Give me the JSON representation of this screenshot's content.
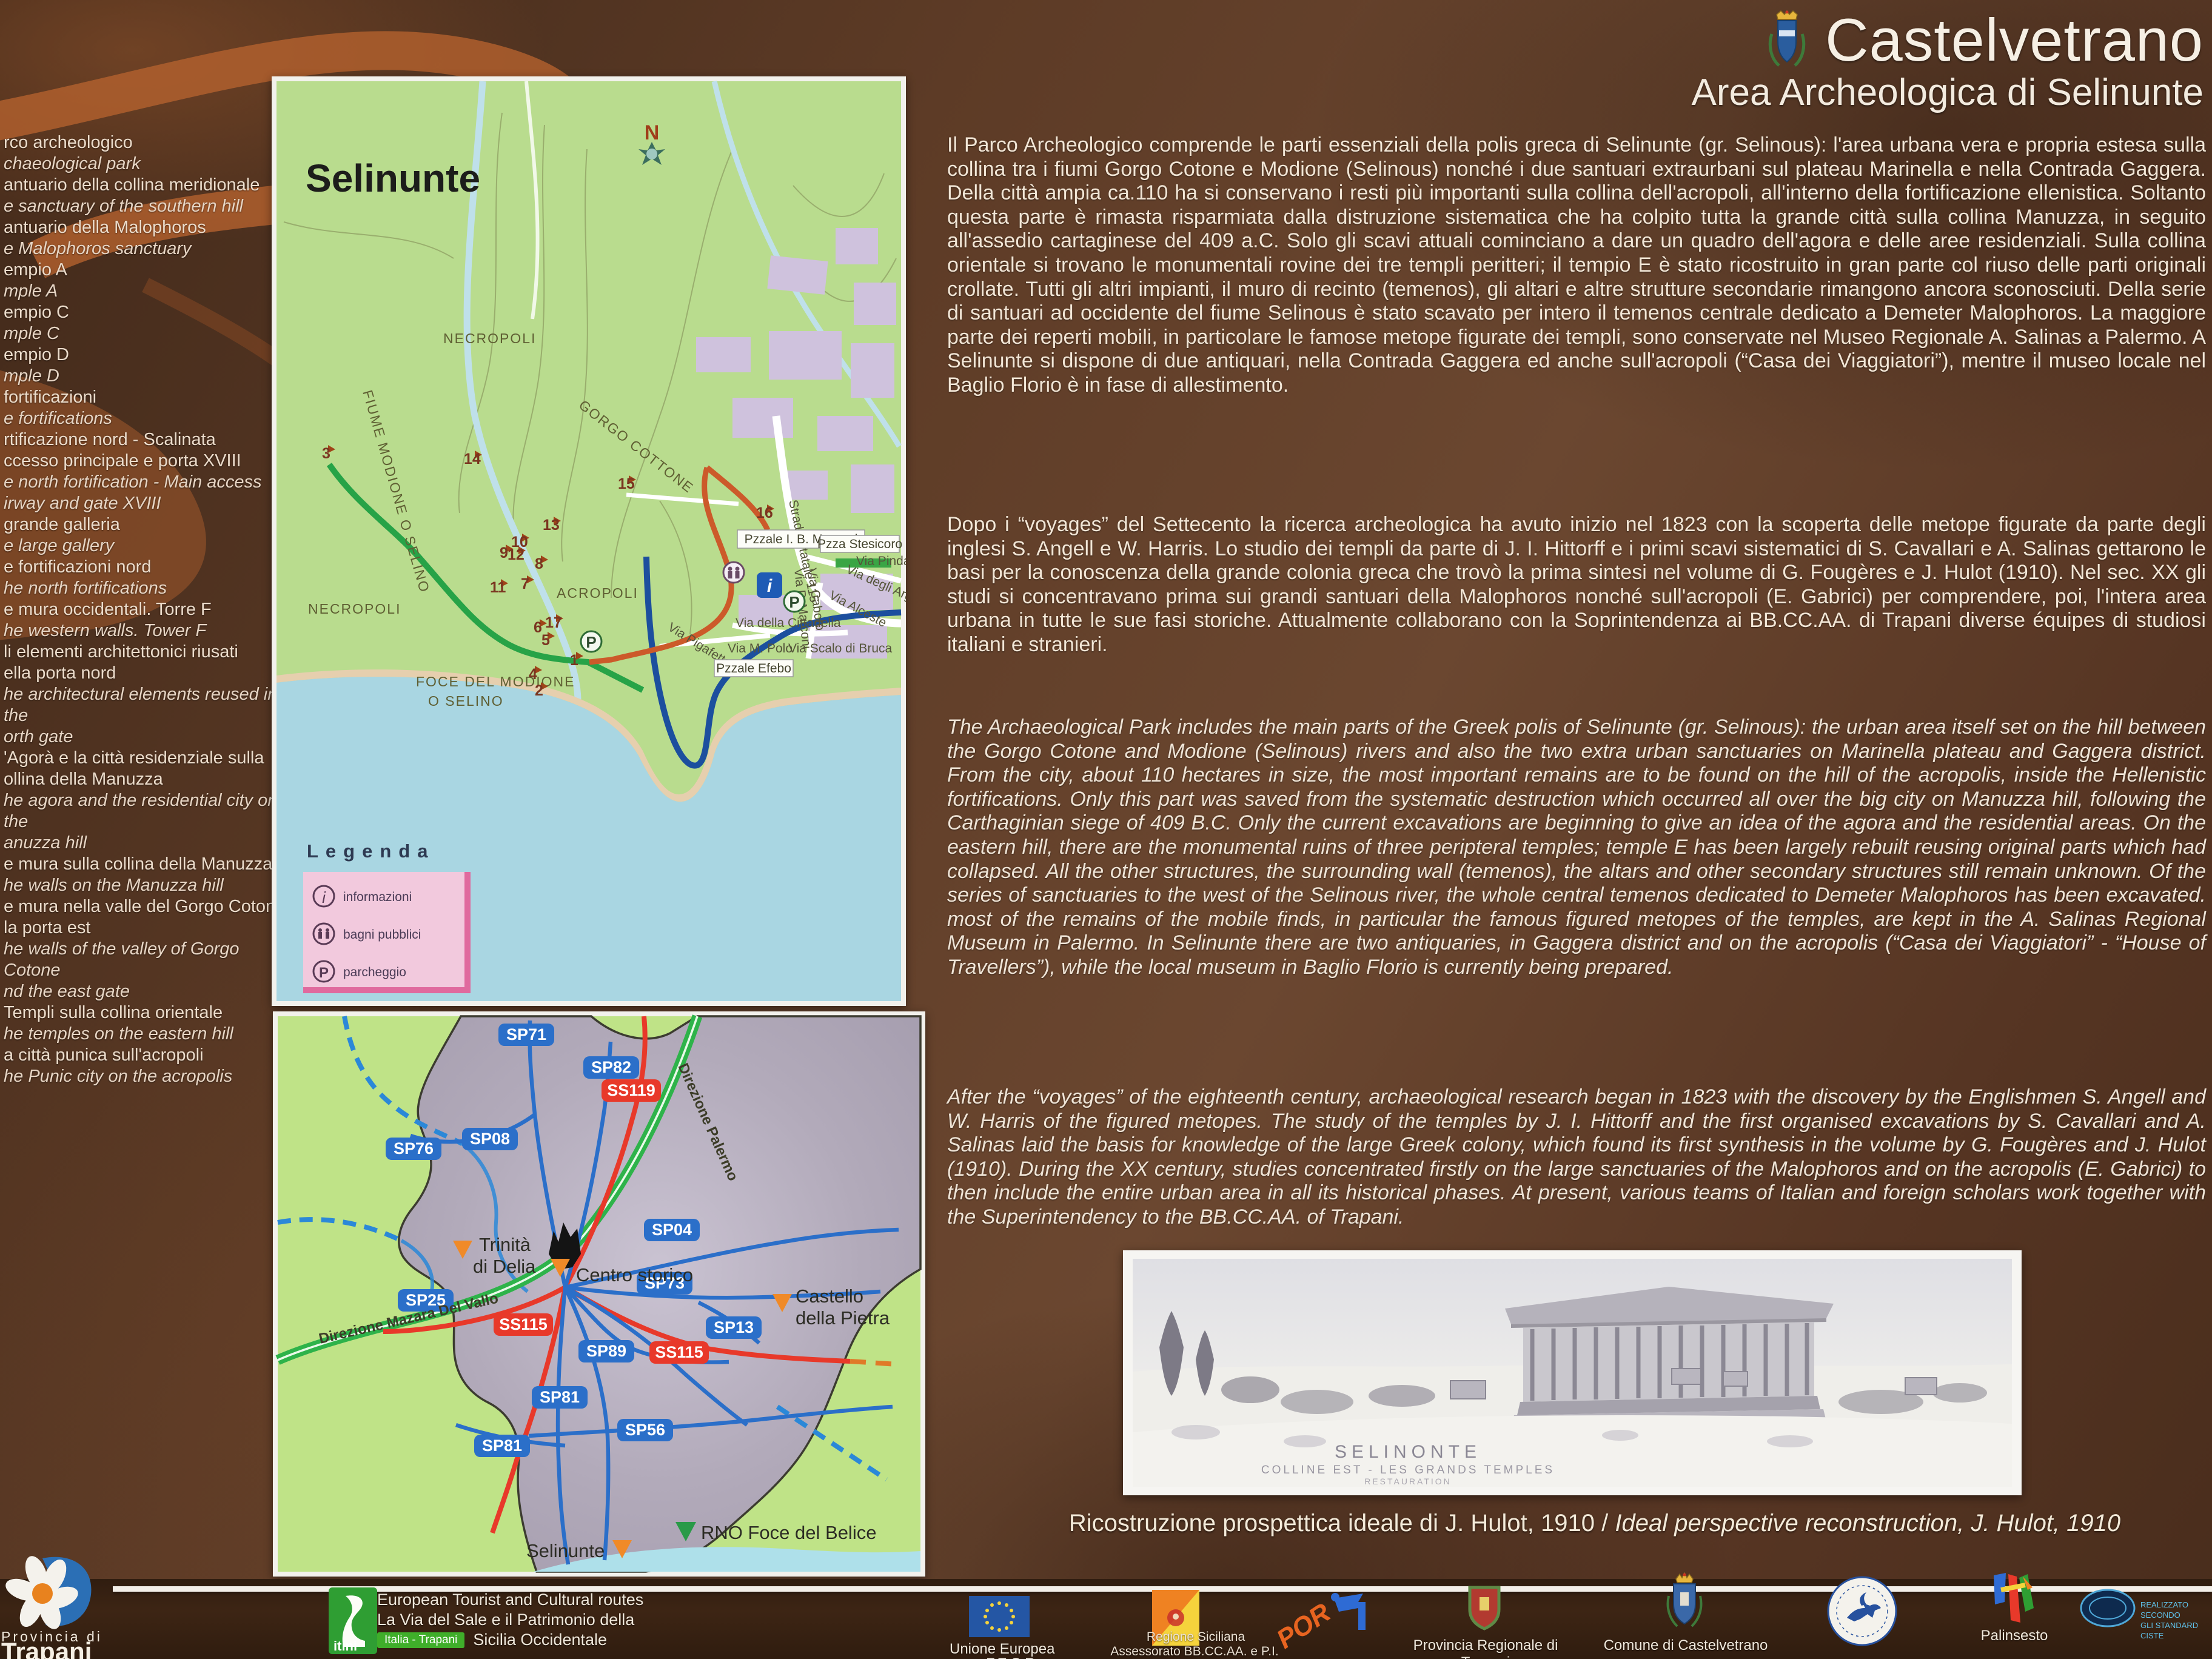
{
  "panel": {
    "title": "Castelvetrano",
    "subtitle": "Area Archeologica di Selinunte",
    "website": "www.visitrapani.it"
  },
  "colors": {
    "panel_brown": "#5d3b26",
    "rust_accent": "#b4622e",
    "map_green": "#b9dc8e",
    "sea_blue": "#a9d6e2",
    "urban_purple": "#cfc2dd",
    "road_badge_blue": "#2b6fc9",
    "road_badge_red": "#e8392a",
    "highway_green": "#2eb34a",
    "route_green": "#27a347",
    "route_blue": "#1c4f9e",
    "route_red": "#cc5a2a",
    "marker_orange": "#f08a28"
  },
  "sidebar": {
    "items": [
      {
        "it": "rco archeologico",
        "en": "chaeological park"
      },
      {
        "it": "antuario della collina meridionale",
        "en": "e sanctuary of the southern hill"
      },
      {
        "it": "antuario della Malophoros",
        "en": "e Malophoros sanctuary"
      },
      {
        "it": "empio A",
        "en": "mple A"
      },
      {
        "it": "empio C",
        "en": "mple C"
      },
      {
        "it": "empio D",
        "en": "mple D"
      },
      {
        "it": "fortificazioni",
        "en": "e fortifications"
      },
      {
        "it": "rtificazione nord - Scalinata\nccesso principale e porta XVIII",
        "en": "e north fortification - Main access\nirway and gate XVIII"
      },
      {
        "it": "grande galleria",
        "en": "e large gallery"
      },
      {
        "it": "e fortificazioni nord",
        "en": "he north fortifications"
      },
      {
        "it": "e mura occidentali. Torre F",
        "en": "he western walls. Tower F"
      },
      {
        "it": "li elementi architettonici riusati\nella porta nord",
        "en": "he architectural elements reused in the\north gate"
      },
      {
        "it": "'Agorà e la città residenziale sulla\nollina della Manuzza",
        "en": "he agora and the residential city on the\nanuzza hill"
      },
      {
        "it": "e mura sulla collina della Manuzza",
        "en": "he walls on the Manuzza hill"
      },
      {
        "it": "e mura nella valle del Gorgo Cotone\nla porta est",
        "en": "he walls of the valley of Gorgo Cotone\nnd the east gate"
      },
      {
        "it": "Templi sulla collina orientale",
        "en": "he temples on the eastern hill"
      },
      {
        "it": "a città punica sull'acropoli",
        "en": "he Punic city on the acropolis"
      }
    ]
  },
  "map_selinunte": {
    "title": "Selinunte",
    "compass": "N",
    "labels": {
      "necropoli_n": "NECROPOLI",
      "necropoli_s": "NECROPOLI",
      "gorgo": "GORGO COTTONE",
      "fiume": "FIUME MODIONE O SELINO",
      "acropoli": "ACROPOLI",
      "foce1": "FOCE DEL MODIONE",
      "foce2": "O SELINO"
    },
    "streets": {
      "ss115": "Strada Statale 115",
      "marconi": "Pzzale I. B. Marconi",
      "stesicoro": "Pzza Stesicoro",
      "pindaro": "Via Pindaro",
      "argonauti": "Via degli Argonauti",
      "caboto": "Via Caboto",
      "pmarconi": "Via P. Marconi",
      "alceste": "Via Alceste",
      "cittadella": "Via della Cittadella",
      "pigafetta": "Via Pigafetta",
      "mpolo": "Via M. Polo",
      "bruca": "Via Scalo di Bruca",
      "efebo": "Pzzale Efebo"
    },
    "markers": [
      "1",
      "2",
      "3",
      "4",
      "5",
      "6",
      "7",
      "8",
      "9",
      "10",
      "11",
      "12",
      "13",
      "14",
      "15",
      "16",
      "17"
    ],
    "icons": {
      "info": "i",
      "parking": "P"
    },
    "legend": {
      "title": "Legenda",
      "items": [
        "informazioni",
        "bagni pubblici",
        "parcheggio"
      ]
    }
  },
  "map_roads": {
    "direction_ne": "Direzione Palermo",
    "direction_sw": "Direzione Mazara Del Vallo",
    "sp71": "SP71",
    "sp82": "SP82",
    "ss119": "SS119",
    "sp76": "SP76",
    "sp08": "SP08",
    "sp25": "SP25",
    "ss115a": "SS115",
    "sp04": "SP04",
    "sp73": "SP73",
    "sp13": "SP13",
    "sp89": "SP89",
    "sp81a": "SP81",
    "sp81b": "SP81",
    "ss115b": "SS115",
    "sp56": "SP56",
    "places": {
      "trinita": "Trinità\ndi Delia",
      "centro": "Centro storico",
      "castello": "Castello\ndella Pietra",
      "selinunte": "Selinunte",
      "rno": "RNO Foce del Belice"
    }
  },
  "article": {
    "p1_it": "Il Parco Archeologico comprende le parti essenziali della polis greca di Selinunte (gr. Selinous): l'area urbana vera e propria estesa sulla collina tra i fiumi Gorgo Cotone e Modione (Selinous) nonché i due santuari extraurbani sul plateau Marinella e nella Contrada Gaggera. Della città ampia ca.110 ha si conservano i resti più importanti sulla collina dell'acropoli, all'interno della fortificazione ellenistica. Soltanto questa parte è rimasta risparmiata dalla distruzione sistematica che ha colpito tutta la grande città sulla collina Manuzza, in seguito all'assedio cartaginese del 409 a.C. Solo gli scavi attuali cominciano a dare un quadro dell'agora e delle aree residenziali. Sulla collina orientale si trovano le monumentali rovine dei tre templi peritteri; il tempio E è stato ricostruito in gran parte col riuso delle parti originali crollate. Tutti gli altri impianti, il muro di recinto (temenos), gli altari e altre strutture secondarie rimangono ancora sconosciuti. Della serie di santuari ad occidente del fiume Selinous è stato scavato per intero il temenos centrale dedicato a Demeter Malophoros.  La maggiore parte dei reperti mobili, in particolare le famose metope figurate dei templi, sono conservate nel Museo Regionale A. Salinas a Palermo. A Selinunte si dispone di due antiquari, nella Contrada Gaggera ed anche sull'acropoli (“Casa dei  Viaggiatori”), mentre il museo locale nel Baglio Florio è in fase di allestimento.",
    "p2_it": "Dopo i “voyages” del Settecento la ricerca archeologica ha avuto inizio nel 1823 con la scoperta delle metope figurate da parte degli inglesi S. Angell  e W.  Harris. Lo studio dei templi da parte di J. I. Hittorff e i primi scavi sistematici di S. Cavallari e A. Salinas gettarono le basi per la conoscenza della grande colonia greca che trovò la prima sintesi nel volume di G. Fougères e J. Hulot (1910). Nel sec. XX gli studi si concentravano prima sui grandi santuari della Malophoros nonché sull'acropoli (E. Gabrici) per comprendere, poi, l'intera area urbana in tutte le sue fasi storiche. Attualmente collaborano con la Soprintendenza ai BB.CC.AA. di Trapani diverse équipes di studiosi italiani e stranieri.",
    "p3_en": "The Archaeological Park includes the main parts of the Greek polis of Selinunte (gr. Selinous): the urban area itself set on the hill between the Gorgo Cotone and Modione (Selinous) rivers and also the two extra urban sanctuaries on Marinella plateau and Gaggera district. From the city, about 110 hectares in size, the most important remains are to be found on the hill of the acropolis, inside the Hellenistic fortifications. Only this part was saved from the systematic destruction which occurred all over the big city on Manuzza hill, following the Carthaginian siege of 409 B.C. Only the current excavations are beginning to give an idea of the agora and the residential areas. On the eastern hill,  there are the monumental ruins of three peripteral temples;  temple E has been largely rebuilt reusing original parts which had collapsed. All the other structures, the surrounding wall (temenos), the altars and other secondary structures still remain unknown. Of the series of sanctuaries to the west of the Selinous river, the whole central temenos dedicated to Demeter Malophoros has been excavated. most of the remains of the mobile finds, in particular the famous figured metopes of the temples, are kept in the A. Salinas Regional Museum in Palermo. In Selinunte there are two antiquaries, in Gaggera district and on the acropolis (“Casa dei Viaggiatori” - “House of Travellers”), while the local museum in Baglio Florio is currently being prepared.",
    "p4_en": "After the “voyages” of the eighteenth century, archaeological research began in 1823 with the discovery by the Englishmen  S.  Angell and W. Harris of the figured metopes. The study of the temples by J. I. Hittorff and the first organised excavations by S. Cavallari and A. Salinas laid the basis for knowledge of the large Greek colony, which found its first synthesis in the volume by G. Fougères and J. Hulot (1910). During the XX century, studies concentrated firstly on the large sanctuaries of the Malophoros and on the acropolis (E. Gabrici) to then include the entire urban area in all its historical phases. At present, various teams of Italian and foreign scholars work together with the Superintendency to the BB.CC.AA. of  Trapani."
  },
  "photo": {
    "inner_title": "SELINONTE",
    "inner_sub": "COLLINE EST - LES GRANDS TEMPLES",
    "inner_sub2": "RESTAURATION",
    "caption_it": "Ricostruzione prospettica ideale di J. Hulot, 1910 / ",
    "caption_en": "Ideal perspective reconstruction, J. Hulot, 1910"
  },
  "footer": {
    "provincia_line1": "Provincia di",
    "provincia_line2": "Trapani",
    "itinerary": [
      "European Tourist and Cultural routes",
      "La Via del Sale e il Patrimonio della"
    ],
    "itinerary_last": "Sicilia Occidentale",
    "itini_logo": "itini",
    "itini_badge": "Italia - Trapani",
    "eu_line1": "Unione Europea",
    "eu_line2": "F.E.S.R.",
    "regione_line1": "Regione Siciliana",
    "regione_line2": "Assessorato BB.CC.AA. e P.I.",
    "regione_line3": "Area Soprintendenza BB. CC. AA. di Trapani",
    "por": "POR",
    "prov_regionale": "Provincia Regionale di Trapani",
    "comune": "Comune di Castelvetrano",
    "palinsesto": "Palinsesto",
    "ciste_line1": "REALIZZATO SECONDO",
    "ciste_line2": "GLI STANDARD CISTE"
  }
}
